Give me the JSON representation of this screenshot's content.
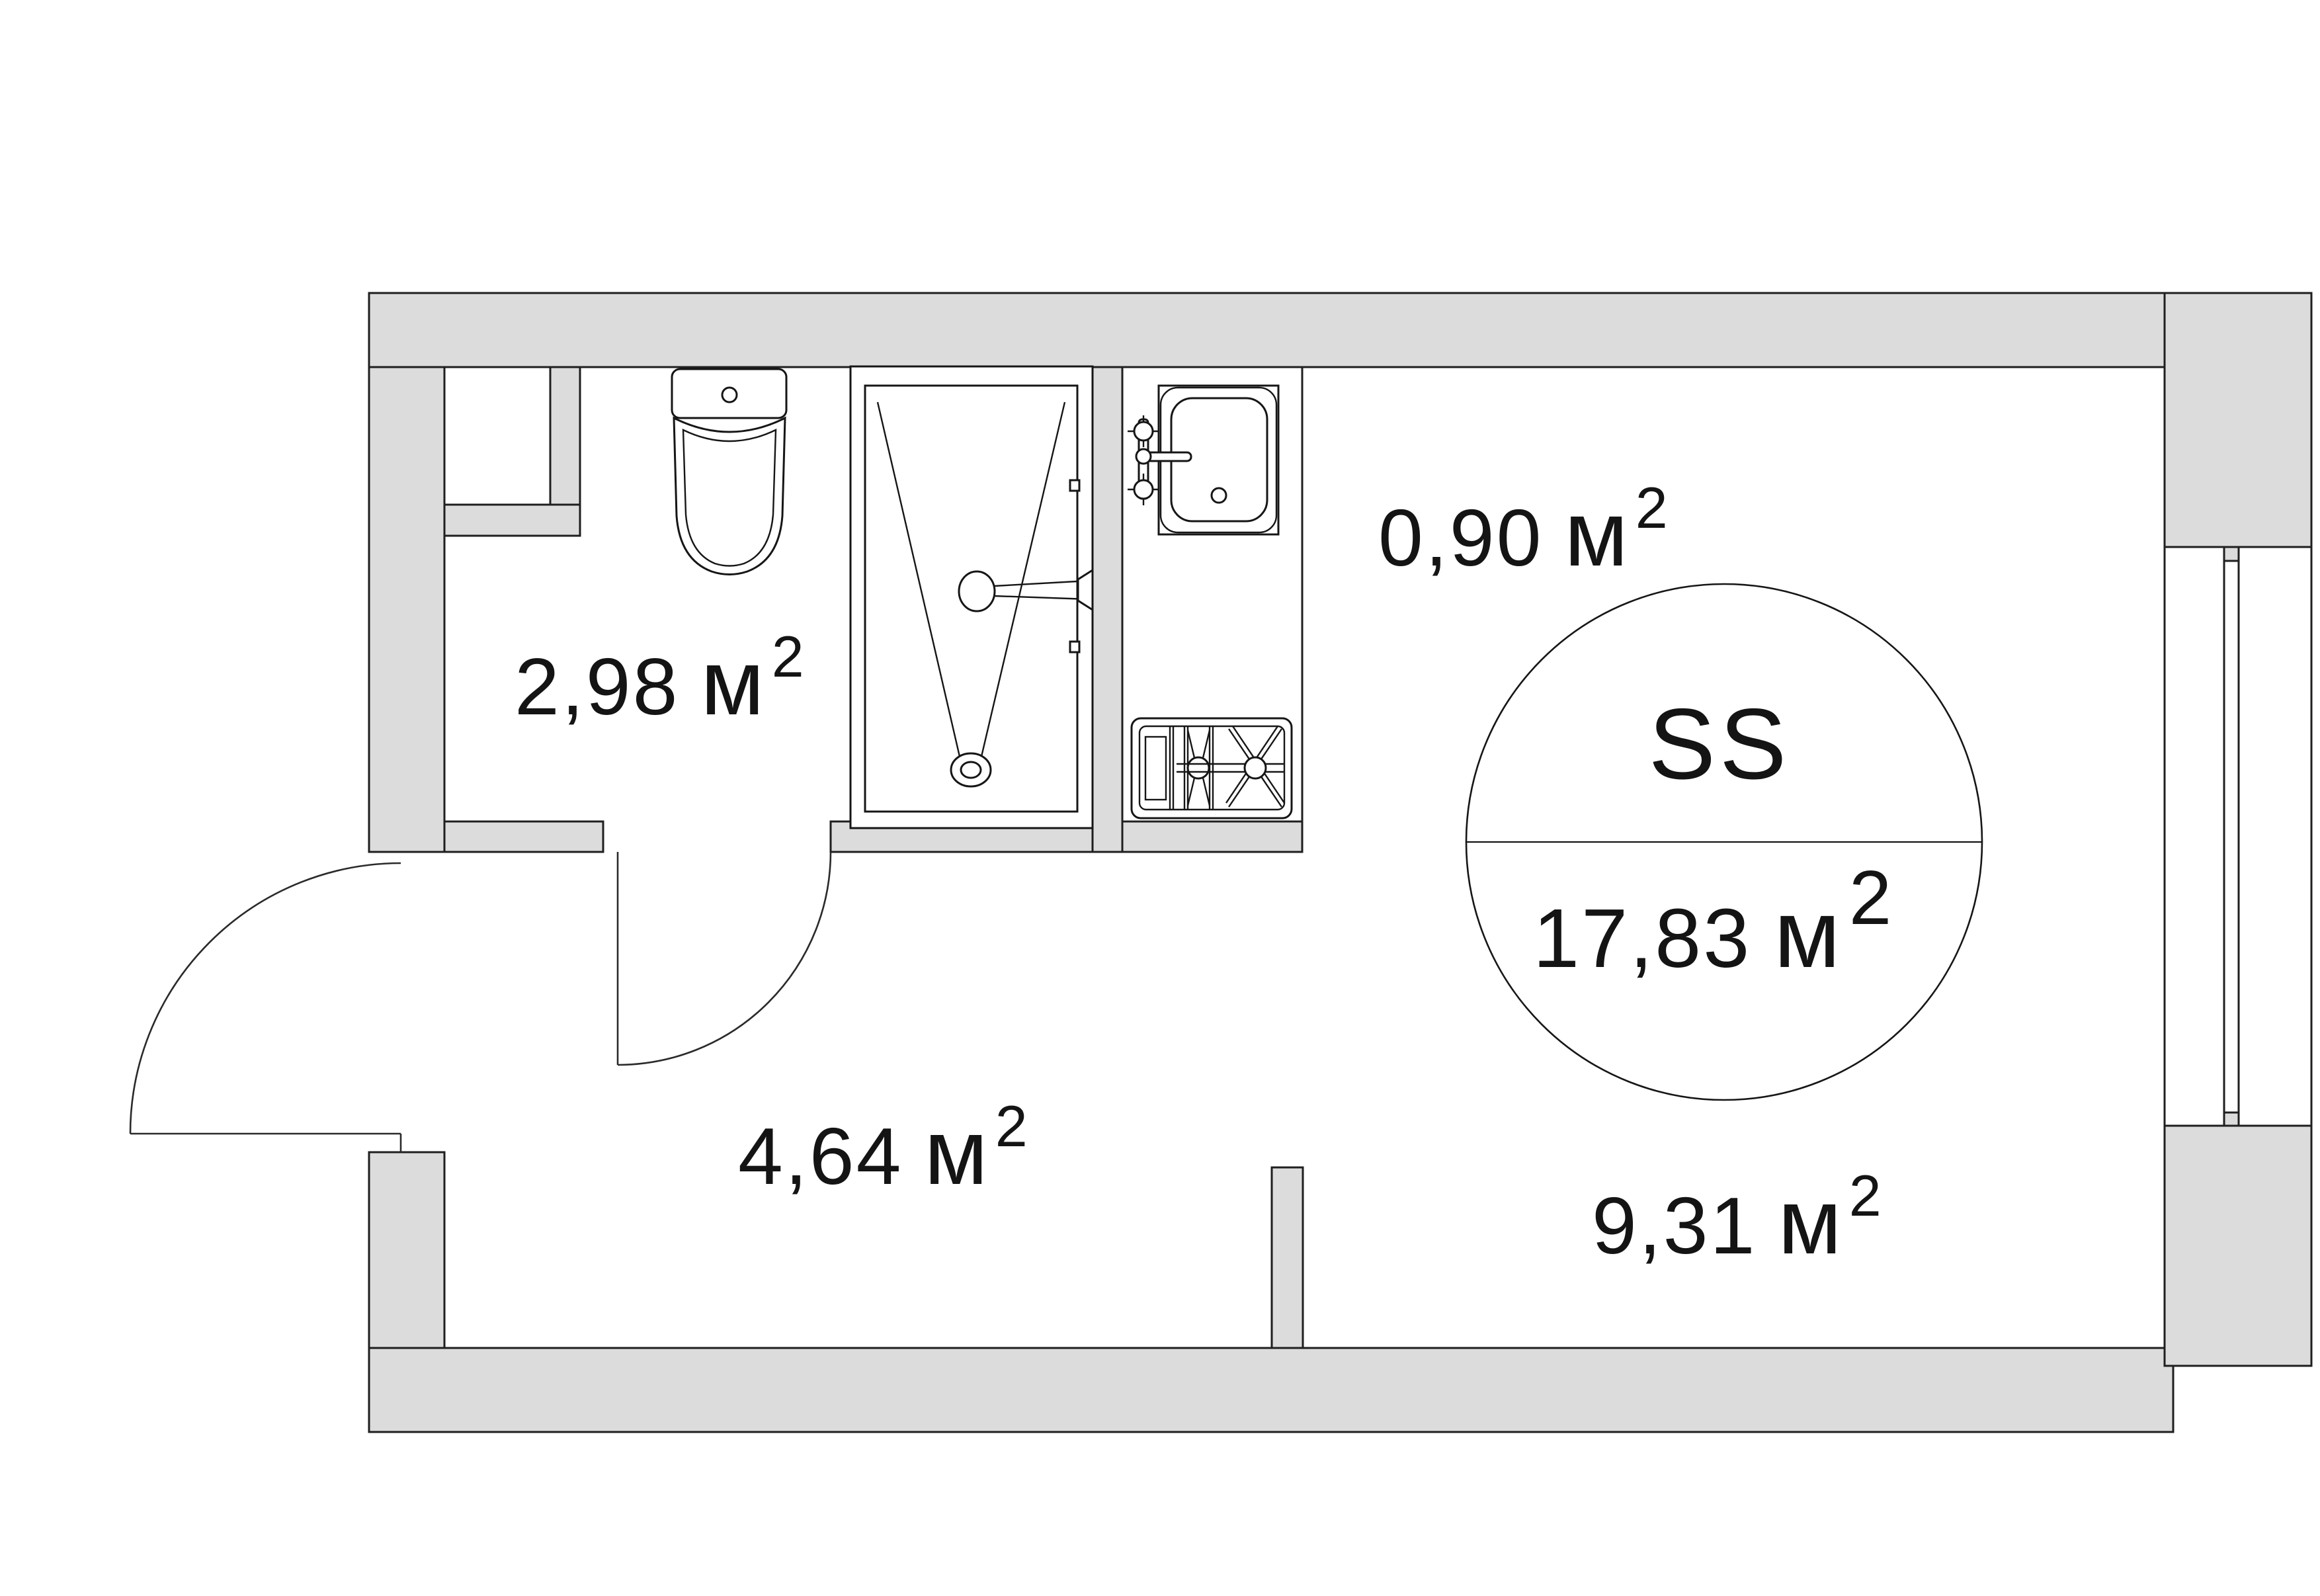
{
  "plan": {
    "unit_badge": {
      "type_label": "SS",
      "area_value": "17,83",
      "area_unit": "м",
      "area_sup": "2"
    },
    "rooms": [
      {
        "id": "bathroom",
        "area_value": "2,98",
        "area_unit": "м",
        "area_sup": "2"
      },
      {
        "id": "kitchen-niche",
        "area_value": "0,90",
        "area_unit": "м",
        "area_sup": "2"
      },
      {
        "id": "hallway",
        "area_value": "4,64",
        "area_unit": "м",
        "area_sup": "2"
      },
      {
        "id": "living-room",
        "area_value": "9,31",
        "area_unit": "м",
        "area_sup": "2"
      }
    ],
    "colors": {
      "wall_fill": "#dcdcdc",
      "line": "#1f1f1f",
      "background": "#ffffff"
    }
  }
}
